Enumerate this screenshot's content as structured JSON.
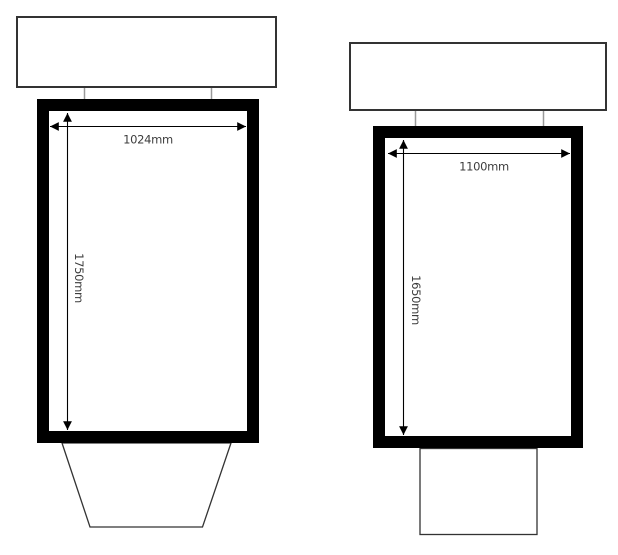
{
  "drawing": {
    "type": "technical-elevation-drawing",
    "units": "mm"
  },
  "diagrams": [
    {
      "name": "left-unit",
      "width_label": "1024mm",
      "height_label": "1750mm",
      "base_shape": "trapezoid"
    },
    {
      "name": "right-unit",
      "width_label": "1100mm",
      "height_label": "1650mm",
      "base_shape": "rectangle"
    }
  ],
  "colors": {
    "frame": "#000000",
    "outline": "#333333",
    "connector": "#999999",
    "dimension": "#000000",
    "label_text": "#3d3d3d",
    "background": "#ffffff"
  }
}
